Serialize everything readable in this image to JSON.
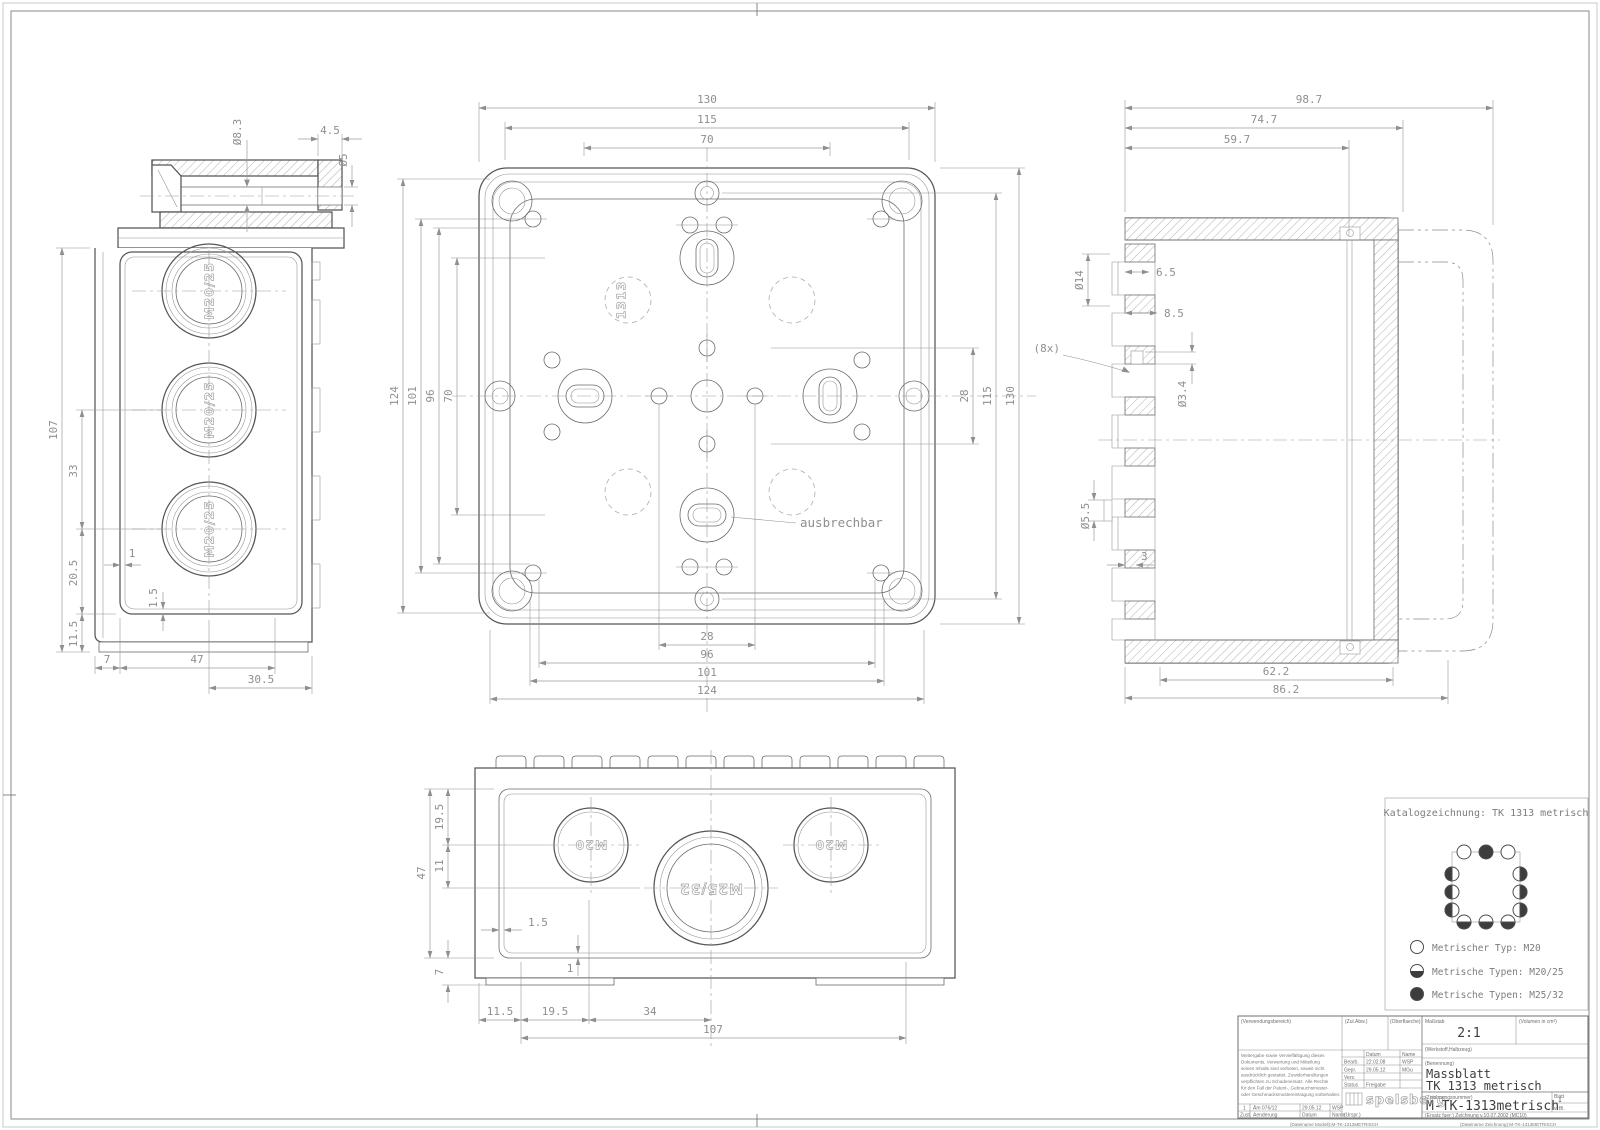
{
  "v": {
    "side": {
      "knockout": "M20/25",
      "d83": "Ø8.3",
      "w45": "4.5",
      "d5": "Ø5",
      "v107": "107",
      "v33": "33",
      "v205": "20.5",
      "v115": "11.5",
      "g1": "1",
      "g15": "1.5",
      "b7": "7",
      "b47": "47",
      "b305": "30.5"
    },
    "plan": {
      "marking": "1313",
      "note": "ausbrechbar",
      "t130": "130",
      "t115": "115",
      "t70": "70",
      "l124": "124",
      "l101": "101",
      "l96": "96",
      "l70": "70",
      "r28": "28",
      "r115": "115",
      "r130": "130",
      "b28": "28",
      "b96": "96",
      "b101": "101",
      "b124": "124"
    },
    "sec": {
      "count": "(8x)",
      "t987": "98.7",
      "t747": "74.7",
      "t597": "59.7",
      "d14": "Ø14",
      "w65": "6.5",
      "w85": "8.5",
      "d34": "Ø3.4",
      "d55": "Ø5.5",
      "w3": "3",
      "b622": "62.2",
      "b862": "86.2"
    },
    "front": {
      "ko": "M20",
      "kobig": "M25/32",
      "v195": "19.5",
      "v11": "11",
      "v47": "47",
      "v7": "7",
      "g15": "1.5",
      "g1": "1",
      "b115": "11.5",
      "b195": "19.5",
      "b34": "34",
      "b107": "107"
    }
  },
  "catalog": {
    "title": "Katalogzeichnung: TK 1313 metrisch",
    "legend": [
      "Metrischer Typ: M20",
      "Metrische Typen: M20/25",
      "Metrische Typen: M25/32"
    ]
  },
  "tb": {
    "verw": "(Verwendungsbereich)",
    "zul": "(Zul.Abw.)",
    "ober": "(Oberflaeche)",
    "mass_l": "Maßstab",
    "mass": "2:1",
    "vol": "(Volumen in cm³)",
    "werk": "(Werkstoff,Halbzeug)",
    "ben_l": "(Benennung)",
    "ben1": "Massblatt",
    "ben2": "TK 1313 metrisch",
    "znr_l": "(Zeichnungsnummer)",
    "znr": "M-TK-1313metrisch",
    "blatt_l": "Blatt",
    "blatt": "1",
    "vbl": "v. Bl.",
    "ersatz": "(Ersatz fuer:)  Zeichnung v.10.07.2002 (MC10)",
    "datum": "Datum",
    "name": "Name",
    "bearb": "Bearb.",
    "bearb_d": "22.02.08",
    "bearb_n": "WSP",
    "gepr": "Gepr.",
    "gepr_d": "29.05.12",
    "gepr_n": "MGu",
    "vers": "Vers.",
    "status": "Status",
    "frei": "Freigabe",
    "rev1": "1",
    "rev_txt": "Äm 076/12",
    "rev_d": "29.05.12",
    "rev_n": "WSP",
    "zust": "Zust.",
    "aend": "Aenderung",
    "datum2": "Datum",
    "name2": "Name",
    "urspr": "(Urspr.)",
    "logo": "spelsberg",
    "file_m": "(Dateiname Modell):M-TK-1313METRISCH",
    "file_z": "(Dateiname Zeichnung):M-TK-1313METRISCH",
    "disclaimer": [
      "Weitergabe sowie Vervielfältigung dieses",
      "Dokuments, Verwertung und Mitteilung",
      "seines Inhalts sind verboten, soweit nicht",
      "ausdrücklich gestattet. Zuwiderhandlungen",
      "verpflichten zu Schadenersatz. Alle Rechte",
      "für den Fall der Patent-, Gebrauchsmuster-",
      "oder Geschmacksmustereintragung vorbehalten."
    ]
  }
}
